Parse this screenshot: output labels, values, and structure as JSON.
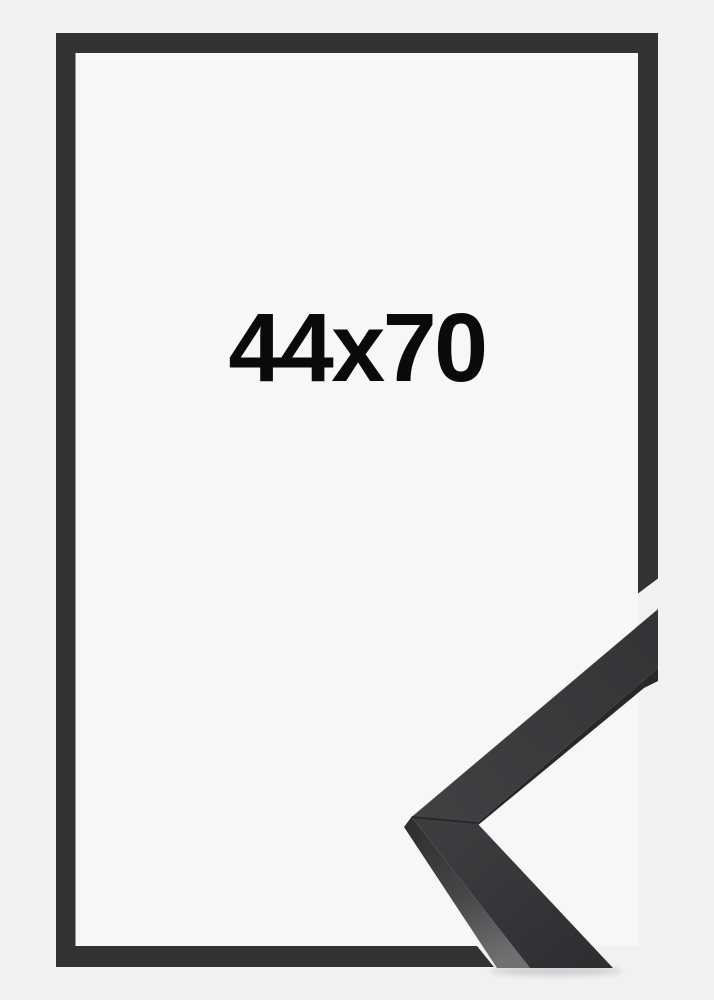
{
  "product": {
    "size_label": "44x70"
  },
  "graphics": {
    "frame_outline_icon": "picture-frame-outline",
    "corner_sample_icon": "frame-corner-moulding"
  },
  "colors": {
    "background": "#f1f1f2",
    "inner_area": "#f7f7f8",
    "frame_outline": "#323235",
    "moulding_edge": "#28282b",
    "label_text": "#0a0a0a"
  }
}
